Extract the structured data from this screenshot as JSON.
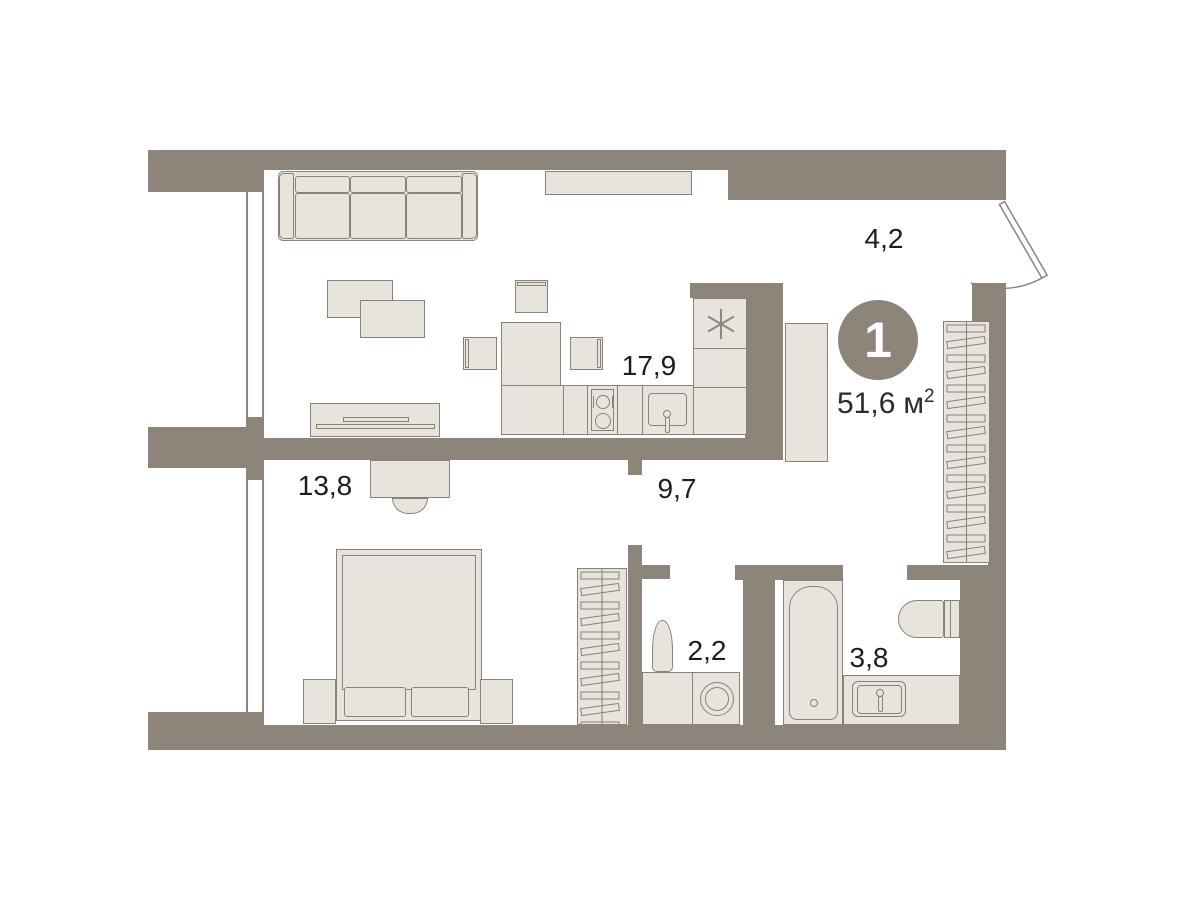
{
  "plan": {
    "badge": "1",
    "total_area": {
      "value": "51,6",
      "unit": "м",
      "superscript": "2"
    },
    "rooms": [
      {
        "key": "living-kitchen",
        "area": "17,9"
      },
      {
        "key": "hallway",
        "area": "4,2"
      },
      {
        "key": "bedroom",
        "area": "13,8"
      },
      {
        "key": "corridor",
        "area": "9,7"
      },
      {
        "key": "laundry",
        "area": "2,2"
      },
      {
        "key": "bathroom",
        "area": "3,8"
      }
    ],
    "colors": {
      "wall": "#8d857a",
      "furniture_fill": "#e7e4de",
      "furniture_border": "#8a8277",
      "label_text": "#1d1d1b",
      "badge_fill": "#8d857a",
      "badge_text": "#ffffff",
      "background": "#ffffff"
    }
  }
}
